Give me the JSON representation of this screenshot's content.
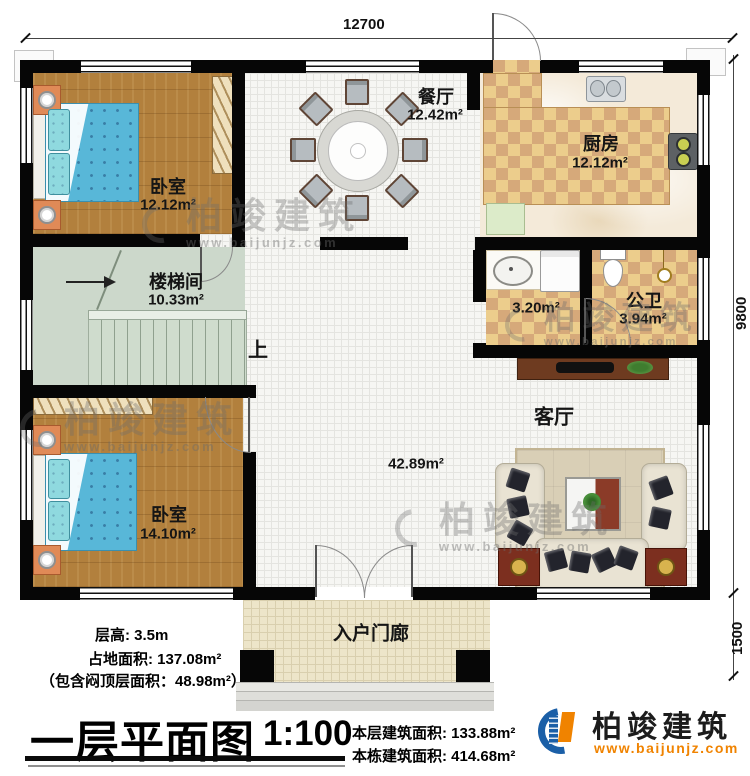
{
  "dimensions": {
    "top": "12700",
    "right_main": "9800",
    "right_porch": "1500"
  },
  "rooms": {
    "bedroom1": {
      "name": "卧室",
      "area": "12.12m²"
    },
    "dining": {
      "name": "餐厅",
      "area": "12.42m²"
    },
    "kitchen": {
      "name": "厨房",
      "area": "12.12m²"
    },
    "stairwell": {
      "name": "楼梯间",
      "area": "10.33m²",
      "up": "上"
    },
    "washroom": {
      "area": "3.20m²"
    },
    "toilet": {
      "name": "公卫",
      "area": "3.94m²"
    },
    "living": {
      "name": "客厅",
      "area": "42.89m²"
    },
    "bedroom2": {
      "name": "卧室",
      "area": "14.10m²"
    },
    "porch": {
      "name": "入户门廊"
    }
  },
  "notes": {
    "floor_height": "层高: 3.5m",
    "footprint": "占地面积: 137.08m²",
    "attic": "（包含闷顶层面积：48.98m²）"
  },
  "title": {
    "text": "一层平面图",
    "scale": "1:100"
  },
  "stats": {
    "floor_area": "本层建筑面积: 133.88m²",
    "total_area": "本栋建筑面积: 414.68m²"
  },
  "brand": {
    "name": "柏竣建筑",
    "site": "www.baijunjz.com",
    "blue": "#1b5fa7",
    "orange": "#f08300"
  },
  "watermark": {
    "name": "柏竣建筑",
    "site": "www.baijunjz.com"
  }
}
